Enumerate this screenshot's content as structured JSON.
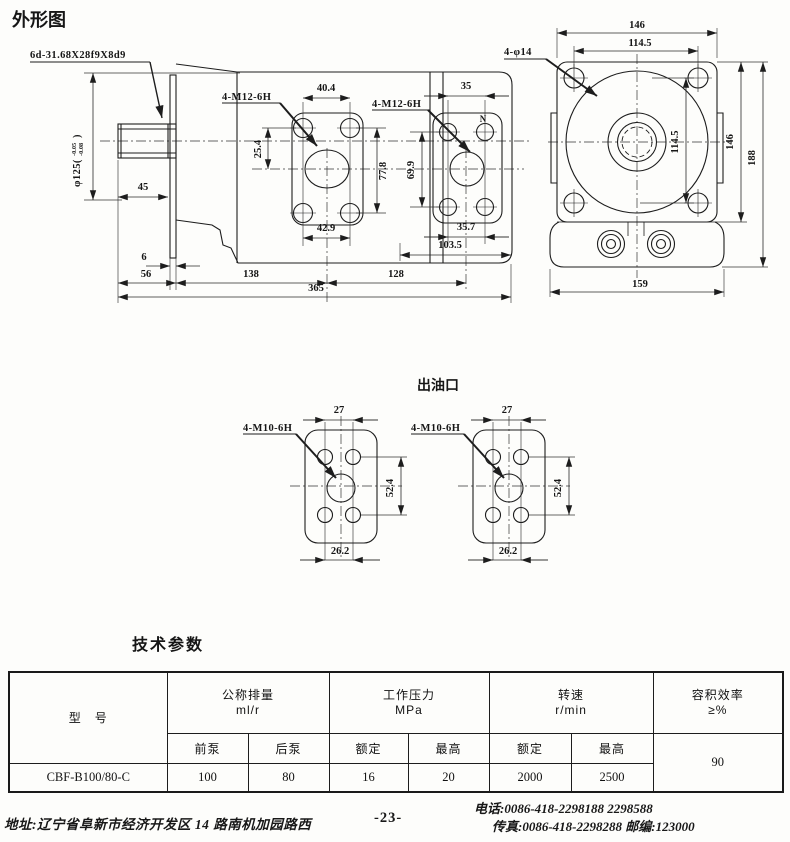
{
  "titles": {
    "outline": "外形图",
    "outlet": "出油口",
    "params": "技术参数"
  },
  "main_view": {
    "spline_label": "6d-31.68X28f9X8d9",
    "shaft_dia": "φ125(",
    "shaft_tol_upper": "-0.05",
    "shaft_tol_lower": "-0.08",
    "shaft_paren_close": ")",
    "thread_front": "4-M12-6H",
    "thread_rear": "4-M12-6H",
    "port_mark": "N",
    "dim_front_top": "40.4",
    "dim_rear_top": "35",
    "dim_center_offset": "25.4",
    "dim_front_vspan": "77.8",
    "dim_rear_vspan": "69.9",
    "dim_front_bottom": "42.9",
    "dim_rear_bottom": "35.7",
    "dim_rear_face": "103.5",
    "dim_shaft_ext": "45",
    "dim_plate_thk": "6",
    "dim_shaft_len": "56",
    "dim_front_center": "138",
    "dim_center_center": "128",
    "dim_total_len": "365"
  },
  "end_view": {
    "hole_label": "4-φ14",
    "dim_width_top": "146",
    "dim_hole_span_h": "114.5",
    "dim_hole_span_v": "114.5",
    "dim_height": "146",
    "dim_total_height": "188",
    "dim_foot_width": "159"
  },
  "outlet_view": {
    "thread": "4-M10-6H",
    "dim_top": "27",
    "dim_side": "52.4",
    "dim_bottom": "26.2"
  },
  "table": {
    "col_model": "型　号",
    "group_displacement": "公称排量",
    "unit_displacement": "ml/r",
    "group_pressure": "工作压力",
    "unit_pressure": "MPa",
    "group_speed": "转速",
    "unit_speed": "r/min",
    "group_efficiency": "容积效率",
    "unit_efficiency": "≥%",
    "sub_front": "前泵",
    "sub_rear": "后泵",
    "sub_rated_p": "额定",
    "sub_max_p": "最高",
    "sub_rated_s": "额定",
    "sub_max_s": "最高",
    "row": {
      "model": "CBF-B100/80-C",
      "front": "100",
      "rear": "80",
      "rated_p": "16",
      "max_p": "20",
      "rated_s": "2000",
      "max_s": "2500",
      "efficiency": "90"
    }
  },
  "footer": {
    "address": "地址:辽宁省阜新市经济开发区 14 路南机加园路西",
    "page": "-23-",
    "phone": "电话:0086-418-2298188    2298588",
    "fax": "传真:0086-418-2298288    邮编:123000"
  }
}
